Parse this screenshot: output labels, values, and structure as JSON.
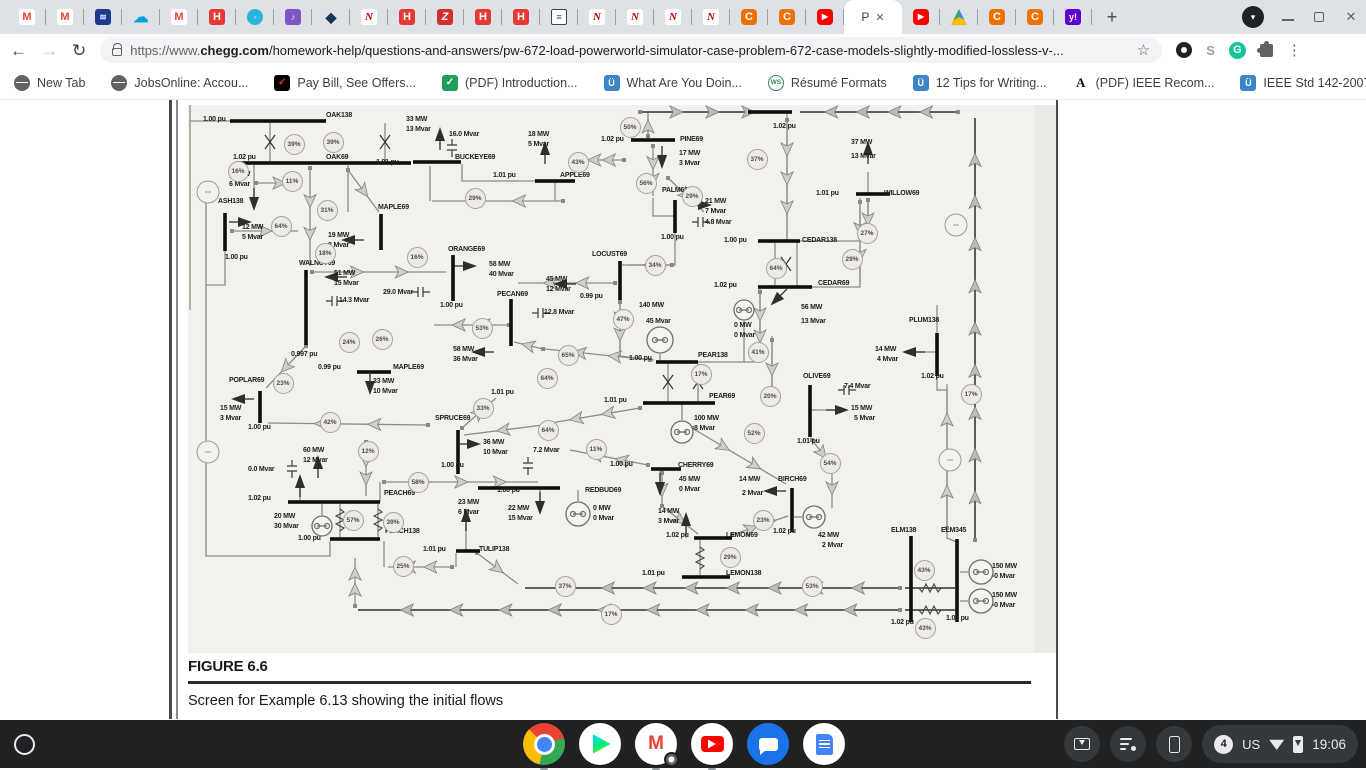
{
  "browser": {
    "tabs_before": [
      "gmail",
      "gmail",
      "scribble",
      "cloud",
      "gmail",
      "hred",
      "swirl",
      "purplep",
      "diamond",
      "niu",
      "hred",
      "zred",
      "hred",
      "hred",
      "doc",
      "niu",
      "niu",
      "niu",
      "niu",
      "chegg",
      "chegg",
      "youtube"
    ],
    "tabs_after": [
      "youtube",
      "drive",
      "chegg",
      "chegg",
      "yahoo"
    ],
    "active_tab": {
      "label": "P",
      "close": "✕"
    },
    "new_tab": "+",
    "address": {
      "scheme": "https://www.",
      "domain": "chegg.com",
      "path": "/homework-help/questions-and-answers/pw-672-load-powerworld-simulator-case-problem-672-case-models-slightly-modified-lossless-v-..."
    },
    "bookmarks": [
      {
        "icon": "globe",
        "label": "New Tab"
      },
      {
        "icon": "globe",
        "label": "JobsOnline: Accou..."
      },
      {
        "icon": "paybill",
        "label": "Pay Bill, See Offers..."
      },
      {
        "icon": "greencheck",
        "label": "(PDF) Introduction..."
      },
      {
        "icon": "owl",
        "label": "What Are You Doin..."
      },
      {
        "icon": "ws",
        "label": "Résumé Formats"
      },
      {
        "icon": "owl",
        "label": "12 Tips for Writing..."
      },
      {
        "icon": "aletter",
        "label": "(PDF) IEEE Recom..."
      },
      {
        "icon": "owl",
        "label": "IEEE Std 142-2007..."
      }
    ],
    "bookmarks_overflow": "»"
  },
  "figure": {
    "label": "FIGURE 6.6",
    "caption": "Screen for Example 6.13 showing the initial flows"
  },
  "diagram": {
    "labels": [
      [
        "1.00 pu",
        203,
        116
      ],
      [
        "OAK138",
        326,
        112
      ],
      [
        "33 MW",
        406,
        116
      ],
      [
        "13 Mvar",
        406,
        126
      ],
      [
        "16.0 Mvar",
        449,
        131
      ],
      [
        "18 MW",
        528,
        131
      ],
      [
        "5 Mvar",
        528,
        141
      ],
      [
        "1.02 pu",
        601,
        136
      ],
      [
        "PINE69",
        680,
        136
      ],
      [
        "1.02 pu",
        773,
        123
      ],
      [
        "37 MW",
        851,
        139
      ],
      [
        "13 Mvar",
        851,
        153
      ],
      [
        "1.02 pu",
        233,
        154
      ],
      [
        "OAK69",
        326,
        154
      ],
      [
        "1.01 pu",
        376,
        159
      ],
      [
        "BUCKEYE69",
        455,
        154
      ],
      [
        "1.01 pu",
        493,
        172
      ],
      [
        "APPLE69",
        560,
        172
      ],
      [
        "23 MW",
        229,
        171
      ],
      [
        "6 Mvar",
        229,
        181
      ],
      [
        "17 MW",
        679,
        150
      ],
      [
        "3 Mvar",
        679,
        160
      ],
      [
        "PALM69",
        662,
        187
      ],
      [
        "1.01 pu",
        816,
        190
      ],
      [
        "WILLOW69",
        884,
        190
      ],
      [
        "21 MW",
        705,
        198
      ],
      [
        "7 Mvar",
        705,
        208
      ],
      [
        "ASH138",
        218,
        198
      ],
      [
        "MAPLE69",
        378,
        204
      ],
      [
        "4.8 Mvar",
        705,
        219
      ],
      [
        "12 MW",
        242,
        224
      ],
      [
        "5 Mvar",
        242,
        234
      ],
      [
        "19 MW",
        328,
        232
      ],
      [
        "8 Mvar",
        328,
        242
      ],
      [
        "1.00 pu",
        661,
        234
      ],
      [
        "1.00 pu",
        724,
        237
      ],
      [
        "CEDAR138",
        802,
        237
      ],
      [
        "ORANGE69",
        448,
        246
      ],
      [
        "1.00 pu",
        225,
        254
      ],
      [
        "LOCUST69",
        592,
        251
      ],
      [
        "WALNUT69",
        299,
        260
      ],
      [
        "58 MW",
        489,
        261
      ],
      [
        "40 Mvar",
        489,
        271
      ],
      [
        "45 MW",
        546,
        276
      ],
      [
        "12 Mvar",
        546,
        286
      ],
      [
        "51 MW",
        334,
        270
      ],
      [
        "15 Mvar",
        334,
        280
      ],
      [
        "1.02 pu",
        714,
        282
      ],
      [
        "CEDAR69",
        818,
        280
      ],
      [
        "29.0 Mvar",
        383,
        289
      ],
      [
        "14.3 Mvar",
        339,
        297
      ],
      [
        "PECAN69",
        497,
        291
      ],
      [
        "0.99 pu",
        580,
        293
      ],
      [
        "1.00 pu",
        440,
        302
      ],
      [
        "140 MW",
        639,
        302
      ],
      [
        "56 MW",
        801,
        304
      ],
      [
        "13 Mvar",
        801,
        318
      ],
      [
        "12.8 Mvar",
        544,
        309
      ],
      [
        "45 Mvar",
        646,
        318
      ],
      [
        "0 MW",
        734,
        322
      ],
      [
        "0 Mvar",
        734,
        332
      ],
      [
        "PLUM138",
        909,
        317
      ],
      [
        "58 MW",
        453,
        346
      ],
      [
        "36 Mvar",
        453,
        356
      ],
      [
        "14 MW",
        875,
        346
      ],
      [
        "4 Mvar",
        877,
        356
      ],
      [
        "0.997 pu",
        291,
        351
      ],
      [
        "1.00 pu",
        629,
        355
      ],
      [
        "PEAR138",
        698,
        352
      ],
      [
        "0.99 pu",
        318,
        364
      ],
      [
        "MAPLE69",
        393,
        364
      ],
      [
        "POPLAR69",
        229,
        377
      ],
      [
        "OLIVE69",
        803,
        373
      ],
      [
        "1.02 pu",
        921,
        373
      ],
      [
        "33 MW",
        373,
        378
      ],
      [
        "10 Mvar",
        373,
        388
      ],
      [
        "7.4 Mvar",
        844,
        383
      ],
      [
        "1.01 pu",
        604,
        397
      ],
      [
        "PEAR69",
        709,
        393
      ],
      [
        "1.01 pu",
        491,
        389
      ],
      [
        "15 MW",
        220,
        405
      ],
      [
        "3 Mvar",
        220,
        415
      ],
      [
        "100 MW",
        694,
        415
      ],
      [
        "8 Mvar",
        694,
        425
      ],
      [
        "15 MW",
        851,
        405
      ],
      [
        "5 Mvar",
        854,
        415
      ],
      [
        "SPRUCE69",
        435,
        415
      ],
      [
        "1.00 pu",
        248,
        424
      ],
      [
        "36 MW",
        483,
        439
      ],
      [
        "10 Mvar",
        483,
        449
      ],
      [
        "1.01 pu",
        797,
        438
      ],
      [
        "7.2 Mvar",
        533,
        447
      ],
      [
        "60 MW",
        303,
        447
      ],
      [
        "12 Mvar",
        303,
        457
      ],
      [
        "1.00 pu",
        441,
        462
      ],
      [
        "1.00 pu",
        610,
        461
      ],
      [
        "CHERRY69",
        678,
        462
      ],
      [
        "0.0 Mvar",
        248,
        466
      ],
      [
        "45 MW",
        679,
        476
      ],
      [
        "0 Mvar",
        679,
        486
      ],
      [
        "14 MW",
        739,
        476
      ],
      [
        "2 Mvar",
        742,
        490
      ],
      [
        "BIRCH69",
        778,
        476
      ],
      [
        "1.02 pu",
        248,
        495
      ],
      [
        "PEACH69",
        384,
        490
      ],
      [
        "1.00 pu",
        497,
        487
      ],
      [
        "REDBUD69",
        585,
        487
      ],
      [
        "23 MW",
        458,
        499
      ],
      [
        "6 Mvar",
        458,
        509
      ],
      [
        "20 MW",
        274,
        513
      ],
      [
        "30 Mvar",
        274,
        523
      ],
      [
        "22 MW",
        508,
        505
      ],
      [
        "15 Mvar",
        508,
        515
      ],
      [
        "0 MW",
        593,
        505
      ],
      [
        "0 Mvar",
        593,
        515
      ],
      [
        "14 MW",
        658,
        508
      ],
      [
        "3 Mvar",
        658,
        518
      ],
      [
        "1.00 pu",
        298,
        535
      ],
      [
        "PEACH138",
        385,
        528
      ],
      [
        "1.02 pu",
        666,
        532
      ],
      [
        "LEMON69",
        726,
        532
      ],
      [
        "1.02 pu",
        773,
        528
      ],
      [
        "42 MW",
        818,
        532
      ],
      [
        "2 Mvar",
        822,
        542
      ],
      [
        "1.01 pu",
        423,
        546
      ],
      [
        "TULIP138",
        479,
        546
      ],
      [
        "ELM138",
        891,
        527
      ],
      [
        "ELM345",
        941,
        527
      ],
      [
        "1.01 pu",
        642,
        570
      ],
      [
        "LEMON138",
        726,
        570
      ],
      [
        "150 MW",
        992,
        563
      ],
      [
        "-0 Mvar",
        992,
        573
      ],
      [
        "150 MW",
        992,
        592
      ],
      [
        "-0 Mvar",
        992,
        602
      ],
      [
        "1.02 pu",
        891,
        619
      ],
      [
        "1.03 pu",
        946,
        615
      ]
    ],
    "gauges": [
      [
        "39%",
        294,
        144
      ],
      [
        "39%",
        333,
        142
      ],
      [
        "16%",
        238,
        171
      ],
      [
        "11%",
        292,
        181
      ],
      [
        "31%",
        327,
        210
      ],
      [
        "64%",
        281,
        226
      ],
      [
        "18%",
        325,
        253
      ],
      [
        "16%",
        417,
        257
      ],
      [
        "29%",
        475,
        198
      ],
      [
        "43%",
        578,
        162
      ],
      [
        "50%",
        630,
        127
      ],
      [
        "56%",
        646,
        183
      ],
      [
        "29%",
        692,
        196
      ],
      [
        "37%",
        757,
        159
      ],
      [
        "27%",
        867,
        233
      ],
      [
        "29%",
        852,
        259
      ],
      [
        "64%",
        776,
        268
      ],
      [
        "34%",
        655,
        265
      ],
      [
        "47%",
        623,
        319
      ],
      [
        "53%",
        482,
        328
      ],
      [
        "24%",
        349,
        342
      ],
      [
        "26%",
        382,
        339
      ],
      [
        "65%",
        568,
        355
      ],
      [
        "64%",
        547,
        378
      ],
      [
        "17%",
        701,
        374
      ],
      [
        "41%",
        758,
        352
      ],
      [
        "23%",
        283,
        383
      ],
      [
        "20%",
        770,
        396
      ],
      [
        "33%",
        483,
        408
      ],
      [
        "42%",
        330,
        422
      ],
      [
        "64%",
        548,
        430
      ],
      [
        "52%",
        754,
        433
      ],
      [
        "11%",
        596,
        449
      ],
      [
        "12%",
        368,
        451
      ],
      [
        "54%",
        830,
        463
      ],
      [
        "58%",
        418,
        482
      ],
      [
        "57%",
        353,
        520
      ],
      [
        "39%",
        393,
        522
      ],
      [
        "23%",
        763,
        520
      ],
      [
        "29%",
        730,
        557
      ],
      [
        "25%",
        403,
        566
      ],
      [
        "37%",
        565,
        586
      ],
      [
        "53%",
        812,
        586
      ],
      [
        "43%",
        924,
        570
      ],
      [
        "17%",
        611,
        614
      ],
      [
        "43%",
        925,
        628
      ],
      [
        "17%",
        971,
        394
      ]
    ]
  },
  "status": {
    "badge": "4",
    "lang": "US",
    "time": "19:06"
  }
}
